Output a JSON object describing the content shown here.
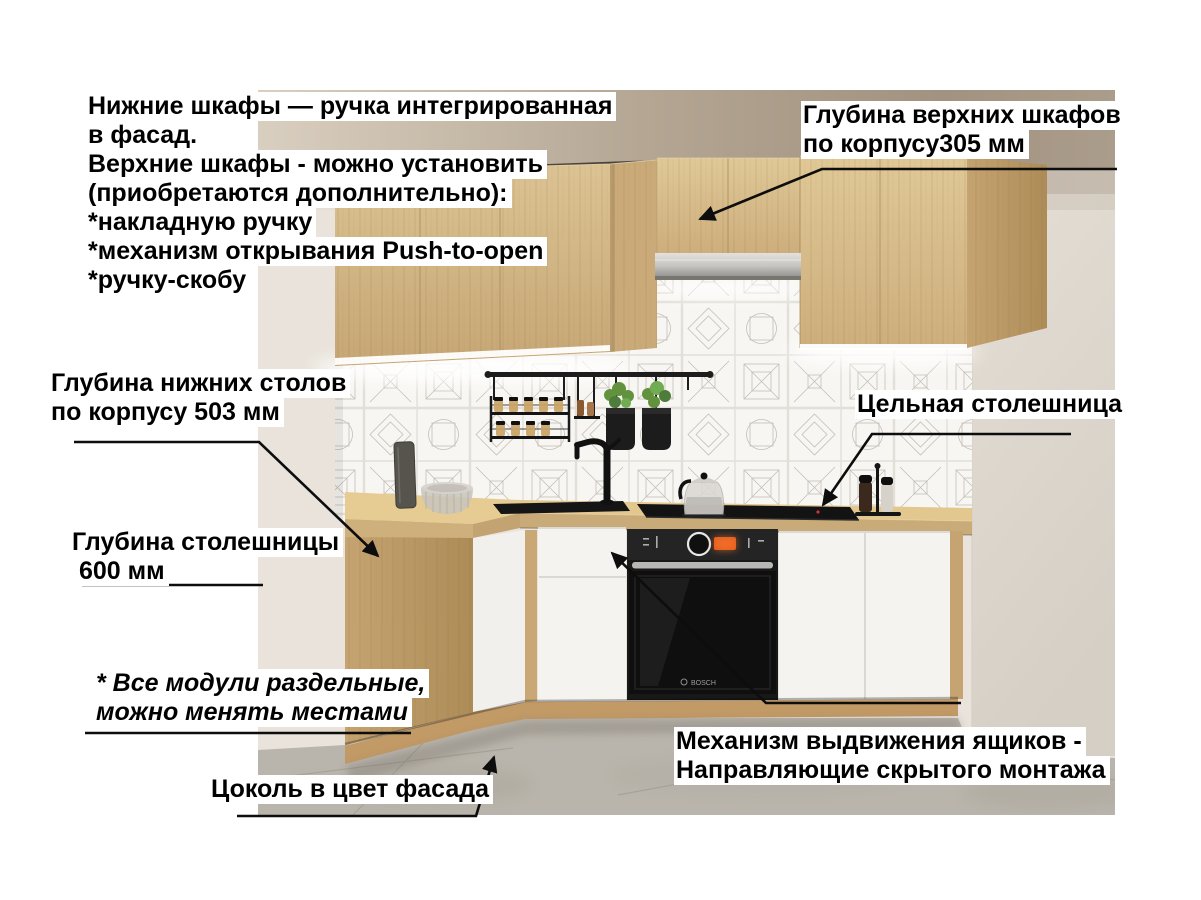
{
  "annotations": {
    "handles_note": {
      "lines": [
        "Нижние шкафы — ручка интегрированная",
        "в фасад.",
        "Верхние шкафы - можно установить",
        "(приобретаются дополнительно):",
        "*накладную ручку",
        "*механизм открывания Push-to-open",
        "*ручку-скобу"
      ]
    },
    "upper_cabinet_depth": {
      "lines": [
        "Глубина верхних шкафов",
        "по корпусу305 мм"
      ]
    },
    "lower_cabinet_depth": {
      "lines": [
        "Глубина нижних столов",
        "по корпусу 503 мм"
      ]
    },
    "solid_countertop": {
      "lines": [
        "Цельная столешница"
      ]
    },
    "countertop_depth": {
      "lines": [
        "Глубина столешницы",
        " 600 мм"
      ]
    },
    "modules_note": {
      "lines": [
        "* Все модули раздельные,",
        "можно менять местами"
      ]
    },
    "plinth_note": {
      "lines": [
        "Цоколь в цвет фасада"
      ]
    },
    "drawer_mechanism": {
      "lines": [
        "Механизм выдвижения ящиков -",
        "Направляющие скрытого монтажа"
      ]
    }
  },
  "scene": {
    "oven_brand": "BOSCH",
    "colors": {
      "wood": "#d2b585",
      "white_front": "#f4f3f0",
      "arrow": "#0d0d0d",
      "wall": "#e9e3db",
      "floor": "#bab5ac"
    }
  }
}
